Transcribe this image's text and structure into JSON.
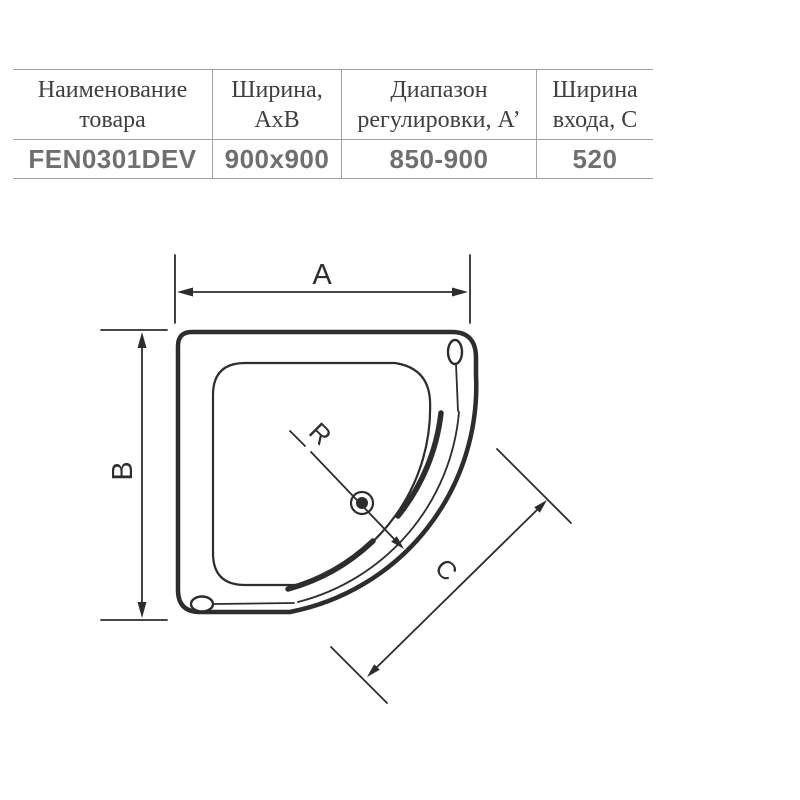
{
  "table": {
    "headers": [
      {
        "line1": "Наименование",
        "line2": "товара"
      },
      {
        "line1": "Ширина,",
        "line2": "АхВ"
      },
      {
        "line1": "Диапазон",
        "line2": "регулировки, А’"
      },
      {
        "line1": "Ширина",
        "line2": "входа, С"
      }
    ],
    "row": {
      "product_code": "FEN0301DEV",
      "width_axb": "900x900",
      "adjust_range": "850-900",
      "entrance_width": "520"
    }
  },
  "drawing": {
    "labels": {
      "width_a": "A",
      "depth_b": "B",
      "radius_r": "R",
      "entrance_c": "C"
    }
  },
  "colors": {
    "line": "#2d2d2d",
    "table_line": "#a3a3a3",
    "header_text": "#404040",
    "value_text": "#6f6f6f"
  }
}
